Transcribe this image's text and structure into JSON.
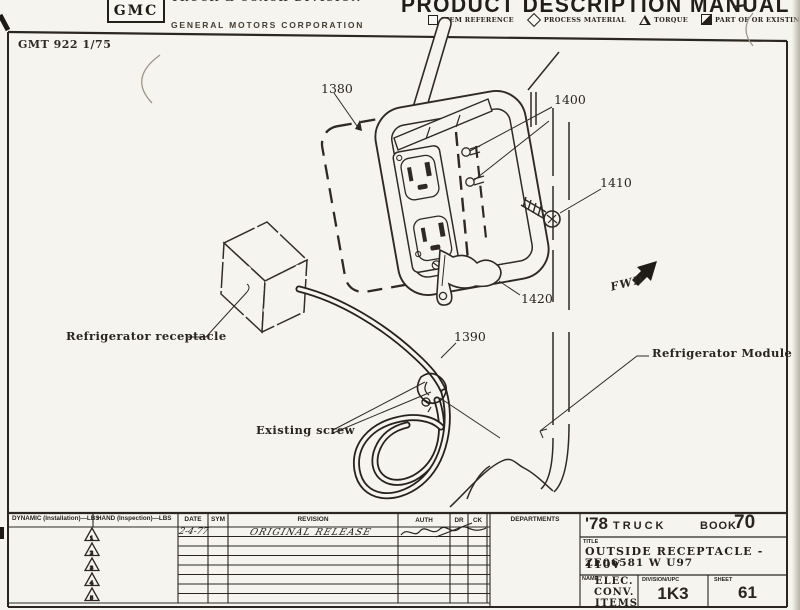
{
  "header": {
    "logo_text": "GMC",
    "division_line": "TRUCK & COACH DIVISION",
    "company_line": "GENERAL MOTORS CORPORATION",
    "manual_title": "PRODUCT DESCRIPTION MANUAL",
    "legend": {
      "item_reference": "ITEM REFERENCE",
      "process_material": "PROCESS MATERIAL",
      "torque": "TORQUE",
      "part_of_or_existing": "PART OF OR EXISTING"
    }
  },
  "sheet": {
    "doc_number": "GMT 922 1/75",
    "callouts": {
      "c1380": "1380",
      "c1400": "1400",
      "c1410": "1410",
      "c1420": "1420",
      "c1390": "1390"
    },
    "labels": {
      "refrigerator_receptacle": "Refrigerator receptacle",
      "existing_screw": "Existing screw",
      "refrigerator_module": "Refrigerator Module",
      "fwd": "FWD"
    }
  },
  "title_block": {
    "dynamic_header": "DYNAMIC (Installation)—LBS",
    "hand_header": "HAND (Inspection)—LBS",
    "date_header": "DATE",
    "sym_header": "SYM",
    "revision_header": "REVISION",
    "auth_header": "AUTH",
    "dr_header": "DR",
    "ck_header": "CK",
    "departments_header": "DEPARTMENTS",
    "triangle_numbers": [
      "1",
      "2",
      "3",
      "4",
      "5"
    ],
    "entries": {
      "date": "2-4-77",
      "revision": "ORIGINAL RELEASE"
    },
    "program_year": "'78",
    "program_vehicle": "TRUCK",
    "book_label": "BOOK",
    "book_number": "70",
    "title_label": "TITLE",
    "title_line1": "OUTSIDE RECEPTACLE - 110V",
    "title_line2": "ZE06581 W U97",
    "name_label": "NAME",
    "name_line1": "ELEC.",
    "name_line2": "CONV.",
    "name_line3": "ITEMS",
    "division_upc_label": "DIVISION/UPC",
    "division_upc_value": "1K3",
    "sheet_label": "SHEET",
    "sheet_number": "61"
  }
}
